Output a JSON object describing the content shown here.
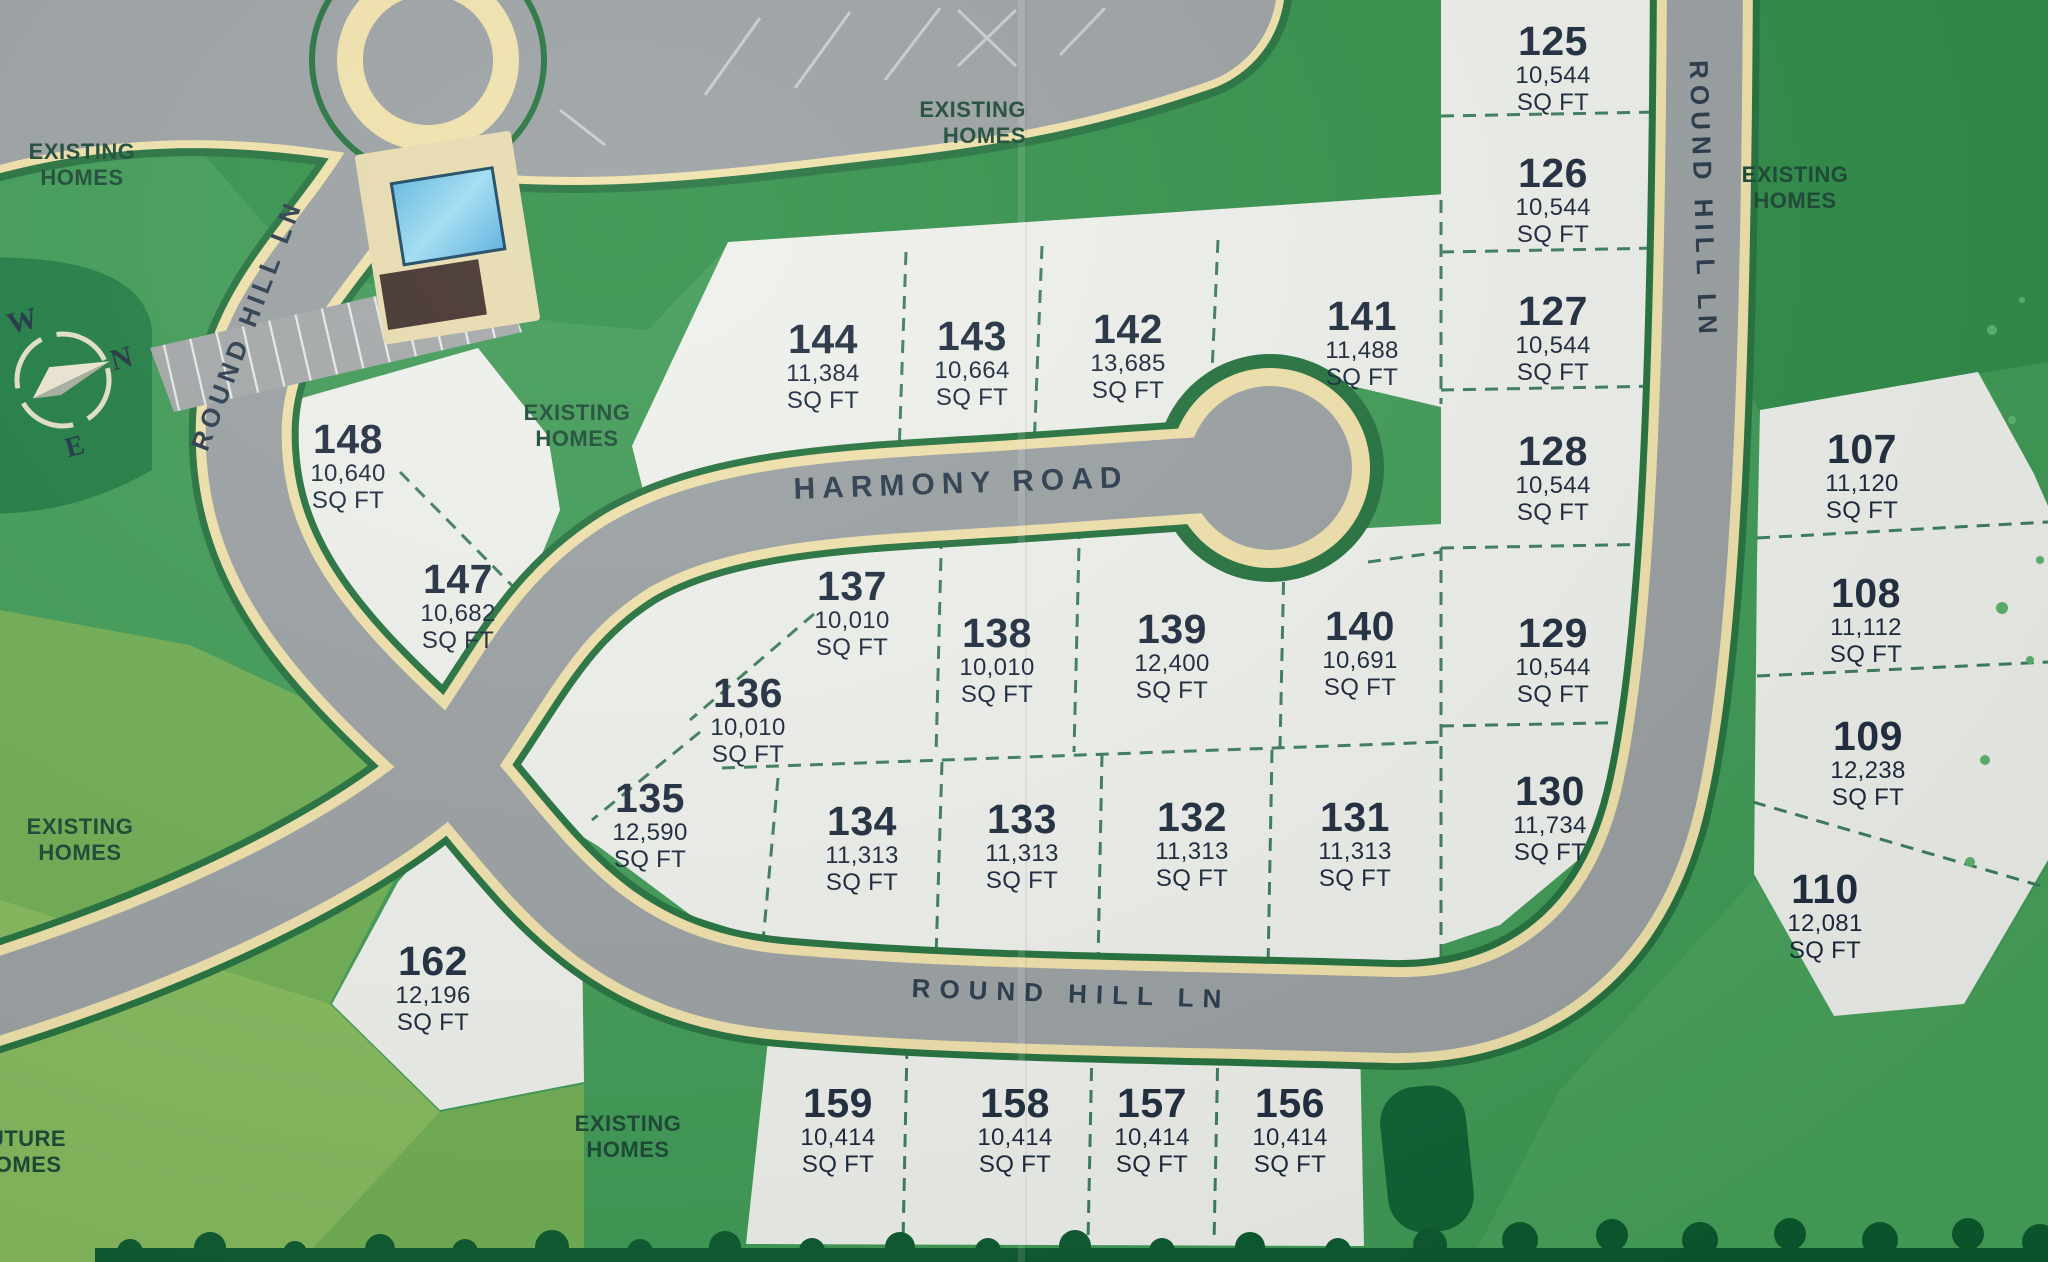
{
  "map": {
    "type": "subdivision-plat-map",
    "roads": {
      "harmony_road": "HARMONY ROAD",
      "round_hill_ln": "ROUND HILL LN"
    },
    "area_labels": {
      "existing_homes": "EXISTING HOMES",
      "future_homes": "FUTURE HOMES"
    },
    "units": {
      "sq_ft": "SQ FT"
    },
    "compass": {
      "n": "N",
      "s": "S",
      "e": "E",
      "w": "W"
    },
    "colors": {
      "grass_green": "#3e9a55",
      "dark_green": "#1e7c41",
      "road_gray": "#9aa0a2",
      "curb_cream": "#f0e2ab",
      "road_edge_green": "#23713d",
      "lot_white": "#eff1ec",
      "lot_text": "#1e2c3e",
      "pool_blue": "#7ccbec"
    },
    "lots": {
      "107": {
        "number": "107",
        "area": "11,120"
      },
      "108": {
        "number": "108",
        "area": "11,112"
      },
      "109": {
        "number": "109",
        "area": "12,238"
      },
      "110": {
        "number": "110",
        "area": "12,081"
      },
      "125": {
        "number": "125",
        "area": "10,544"
      },
      "126": {
        "number": "126",
        "area": "10,544"
      },
      "127": {
        "number": "127",
        "area": "10,544"
      },
      "128": {
        "number": "128",
        "area": "10,544"
      },
      "129": {
        "number": "129",
        "area": "10,544"
      },
      "130": {
        "number": "130",
        "area": "11,734"
      },
      "131": {
        "number": "131",
        "area": "11,313"
      },
      "132": {
        "number": "132",
        "area": "11,313"
      },
      "133": {
        "number": "133",
        "area": "11,313"
      },
      "134": {
        "number": "134",
        "area": "11,313"
      },
      "135": {
        "number": "135",
        "area": "12,590"
      },
      "136": {
        "number": "136",
        "area": "10,010"
      },
      "137": {
        "number": "137",
        "area": "10,010"
      },
      "138": {
        "number": "138",
        "area": "10,010"
      },
      "139": {
        "number": "139",
        "area": "12,400"
      },
      "140": {
        "number": "140",
        "area": "10,691"
      },
      "141": {
        "number": "141",
        "area": "11,488"
      },
      "142": {
        "number": "142",
        "area": "13,685"
      },
      "143": {
        "number": "143",
        "area": "10,664"
      },
      "144": {
        "number": "144",
        "area": "11,384"
      },
      "147": {
        "number": "147",
        "area": "10,682"
      },
      "148": {
        "number": "148",
        "area": "10,640"
      },
      "156": {
        "number": "156",
        "area": "10,414"
      },
      "157": {
        "number": "157",
        "area": "10,414"
      },
      "158": {
        "number": "158",
        "area": "10,414"
      },
      "159": {
        "number": "159",
        "area": "10,414"
      },
      "162": {
        "number": "162",
        "area": "12,196"
      }
    }
  }
}
